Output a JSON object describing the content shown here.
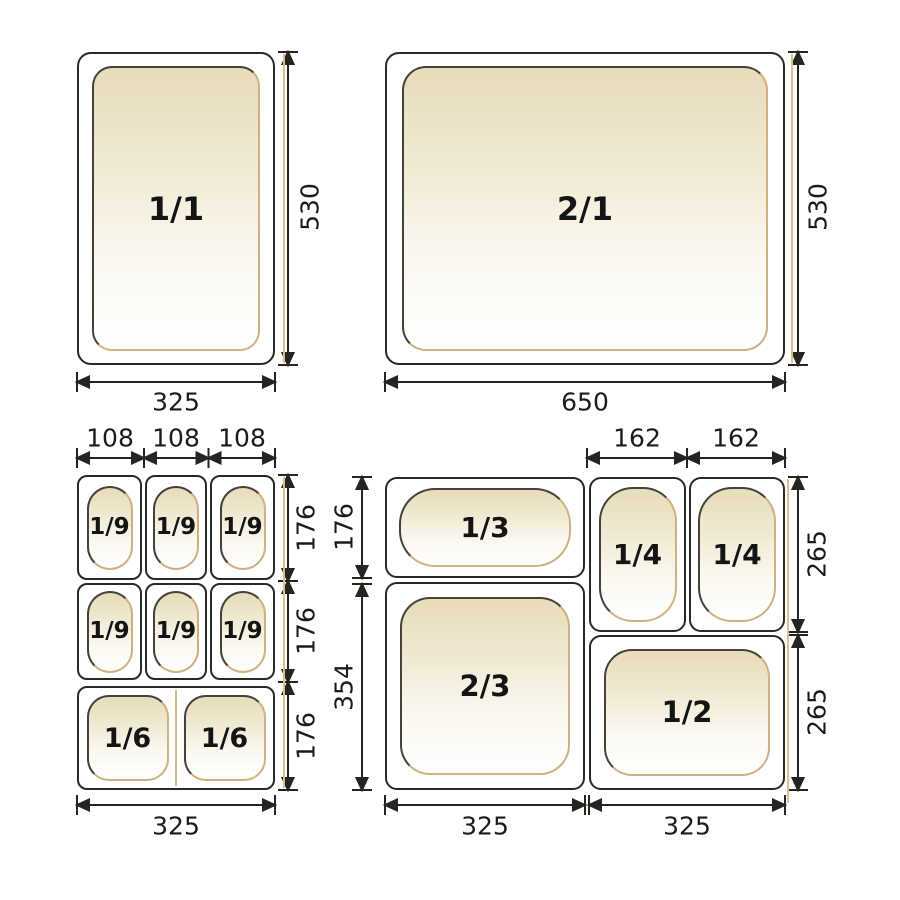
{
  "colors": {
    "line": "#26241f",
    "pan_border_dark": "#2b2925",
    "pan_border_tan": "#d0b081",
    "pan_fill_top": "#e7dcba",
    "pan_fill_bottom": "#ffffff"
  },
  "top_left": {
    "pan_label": "1/1",
    "width": "325",
    "height": "530"
  },
  "top_right": {
    "pan_label": "2/1",
    "width": "650",
    "height": "530"
  },
  "bottom_left": {
    "col_widths": [
      "108",
      "108",
      "108"
    ],
    "row_heights": [
      "176",
      "176",
      "176"
    ],
    "total_width": "325",
    "cells": [
      "1/9",
      "1/9",
      "1/9",
      "1/9",
      "1/9",
      "1/9"
    ],
    "sixths": [
      "1/6",
      "1/6"
    ]
  },
  "bottom_right": {
    "top_widths": [
      "162",
      "162"
    ],
    "left_heights": [
      "176",
      "354"
    ],
    "right_heights": [
      "265",
      "265"
    ],
    "bottom_widths": [
      "325",
      "325"
    ],
    "pans": {
      "third": "1/3",
      "quarter_left": "1/4",
      "quarter_right": "1/4",
      "two_thirds": "2/3",
      "half": "1/2"
    }
  }
}
